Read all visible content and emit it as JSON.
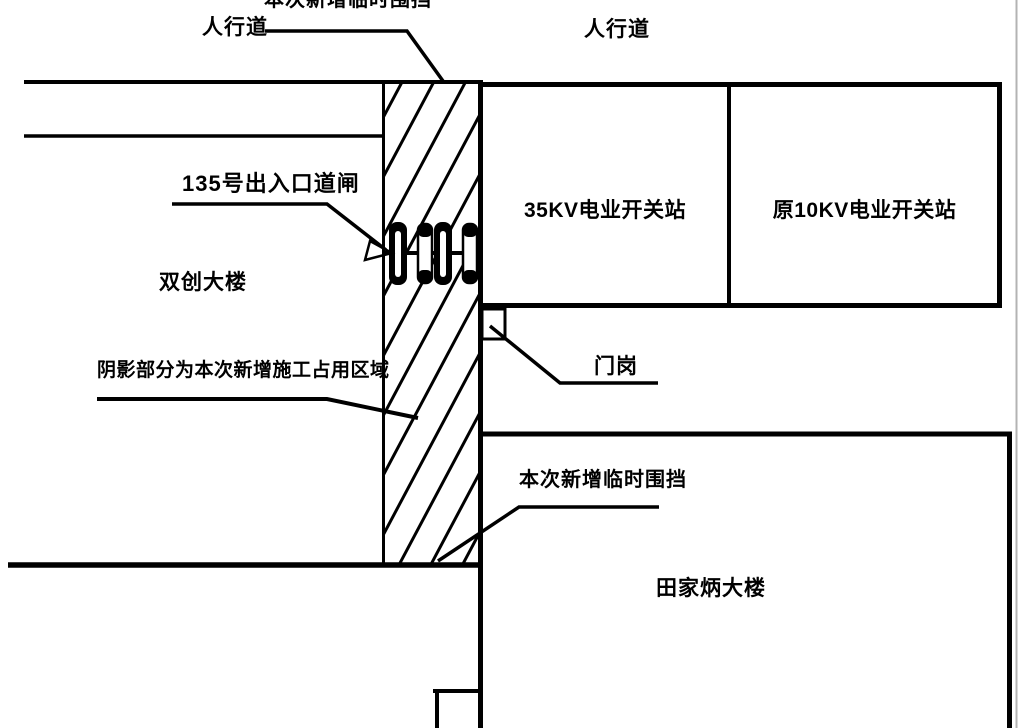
{
  "labels": {
    "top_fence": "本次新增临时围挡",
    "sidewalk_left": "人行道",
    "sidewalk_right": "人行道",
    "gate": "135号出入口道闸",
    "building_shuangchuang": "双创大楼",
    "station_35kv": "35KV电业开关站",
    "station_10kv": "原10KV电业开关站",
    "guard_post": "门岗",
    "shaded_note": "阴影部分为本次新增施工占用区域",
    "lower_fence": "本次新增临时围挡",
    "building_tianjiabing": "田家炳大楼"
  },
  "icons": {
    "gate_barrier": "barrier-spool-row",
    "hatch": "diagonal-construction-hatch"
  },
  "colors": {
    "line": "#000000",
    "background": "#ffffff",
    "page_edge": "#b3b3b3"
  }
}
